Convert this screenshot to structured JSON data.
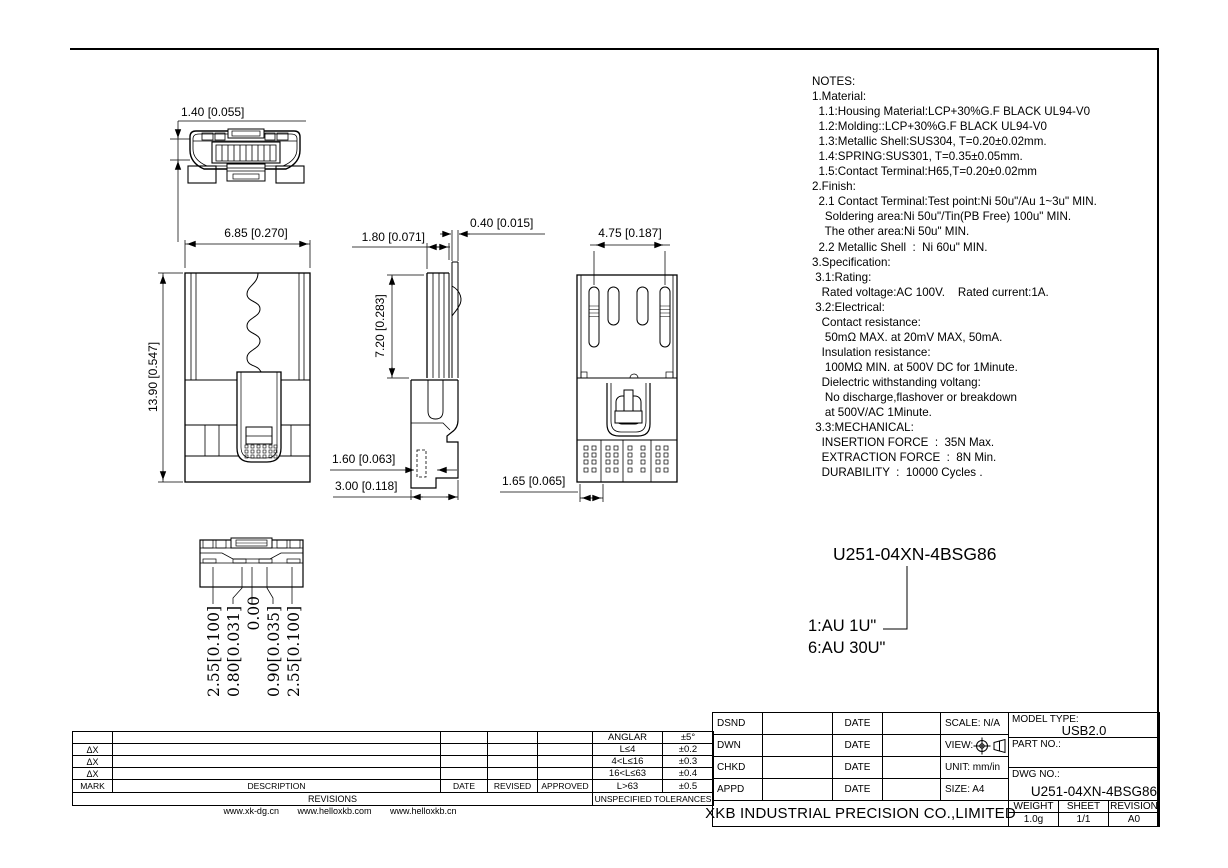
{
  "drawing": {
    "dims": {
      "face_width": "1.40 [0.055]",
      "front_width": "6.85 [0.270]",
      "front_height": "13.90 [0.547]",
      "side_top_width": "1.80 [0.071]",
      "spring_thickness": "0.40 [0.015]",
      "shell_height": "7.20 [0.283]",
      "foot_width": "1.60 [0.063]",
      "base_width": "3.00 [0.118]",
      "slot_span": "4.75 [0.187]",
      "pad_pitch": "1.65 [0.065]",
      "bottom_offsets": [
        "2.55[0.100]",
        "0.80[0.031]",
        "0.00",
        "0.90[0.035]",
        "2.55[0.100]"
      ]
    },
    "callout": {
      "part_number": "U251-04XN-4BSG86",
      "plating_1": "1:AU 1U\"",
      "plating_6": "6:AU 30U\""
    }
  },
  "notes": {
    "lines": [
      "NOTES:",
      "1.Material:",
      "  1.1:Housing Material:LCP+30%G.F BLACK UL94-V0",
      "  1.2:Molding::LCP+30%G.F BLACK UL94-V0",
      "  1.3:Metallic Shell:SUS304, T=0.20±0.02mm.",
      "  1.4:SPRING:SUS301, T=0.35±0.05mm.",
      "  1.5:Contact Terminal:H65,T=0.20±0.02mm",
      "2.Finish:",
      "  2.1 Contact Terminal:Test point:Ni 50u\"/Au 1~3u\" MIN.",
      "    Soldering area:Ni 50u\"/Tin(PB Free) 100u\" MIN.",
      "    The other area:Ni 50u\" MIN.",
      "  2.2 Metallic Shell  :  Ni 60u\" MIN.",
      "3.Specification:",
      " 3.1:Rating:",
      "   Rated voltage:AC 100V.    Rated current:1A.",
      " 3.2:Electrical:",
      "   Contact resistance:",
      "    50mΩ MAX. at 20mV MAX, 50mA.",
      "   Insulation resistance:",
      "    100MΩ MIN. at 500V DC for 1Minute.",
      "   Dielectric withstanding voltang:",
      "    No discharge,flashover or breakdown",
      "    at 500V/AC 1Minute.",
      " 3.3:MECHANICAL:",
      "   INSERTION FORCE  :  35N Max.",
      "   EXTRACTION FORCE  :  8N Min.",
      "   DURABILITY  :  10000 Cycles ."
    ]
  },
  "revisions": {
    "marks": [
      "ΔX",
      "ΔX",
      "ΔX"
    ],
    "headers": [
      "MARK",
      "DESCRIPTION",
      "DATE",
      "REVISED",
      "APPROVED"
    ],
    "footer": "REVISIONS"
  },
  "tolerances": {
    "rows": [
      {
        "range": "ANGLAR",
        "tol": "±5°"
      },
      {
        "range": "L≤4",
        "tol": "±0.2"
      },
      {
        "range": "4<L≤16",
        "tol": "±0.3"
      },
      {
        "range": "16<L≤63",
        "tol": "±0.4"
      },
      {
        "range": "L>63",
        "tol": "±0.5"
      }
    ],
    "footer": "UNSPECIFIED TOLERANCES"
  },
  "footer_links": [
    "www.xk-dg.cn",
    "www.helloxkb.com",
    "www.helloxkb.cn"
  ],
  "title_block": {
    "roles": [
      "DSND",
      "DWN",
      "CHKD",
      "APPD"
    ],
    "date_label": "DATE",
    "scale": "SCALE: N/A",
    "view_label": "VIEW:",
    "unit": "UNIT: mm/in",
    "size": "SIZE: A4",
    "model_type_label": "MODEL TYPE:",
    "model_type_value": "USB2.0",
    "part_no_label": "PART NO.:",
    "dwg_no_label": "DWG NO.:",
    "dwg_no_value": "U251-04XN-4BSG86",
    "weight_label": "WEIGHT",
    "sheet_label": "SHEET",
    "revision_label": "REVISION",
    "weight_value": "1.0g",
    "sheet_value": "1/1",
    "revision_value": "A0",
    "company": "XKB INDUSTRIAL PRECISION CO.,LIMITED"
  },
  "colors": {
    "line": "#000000",
    "background": "#ffffff"
  }
}
